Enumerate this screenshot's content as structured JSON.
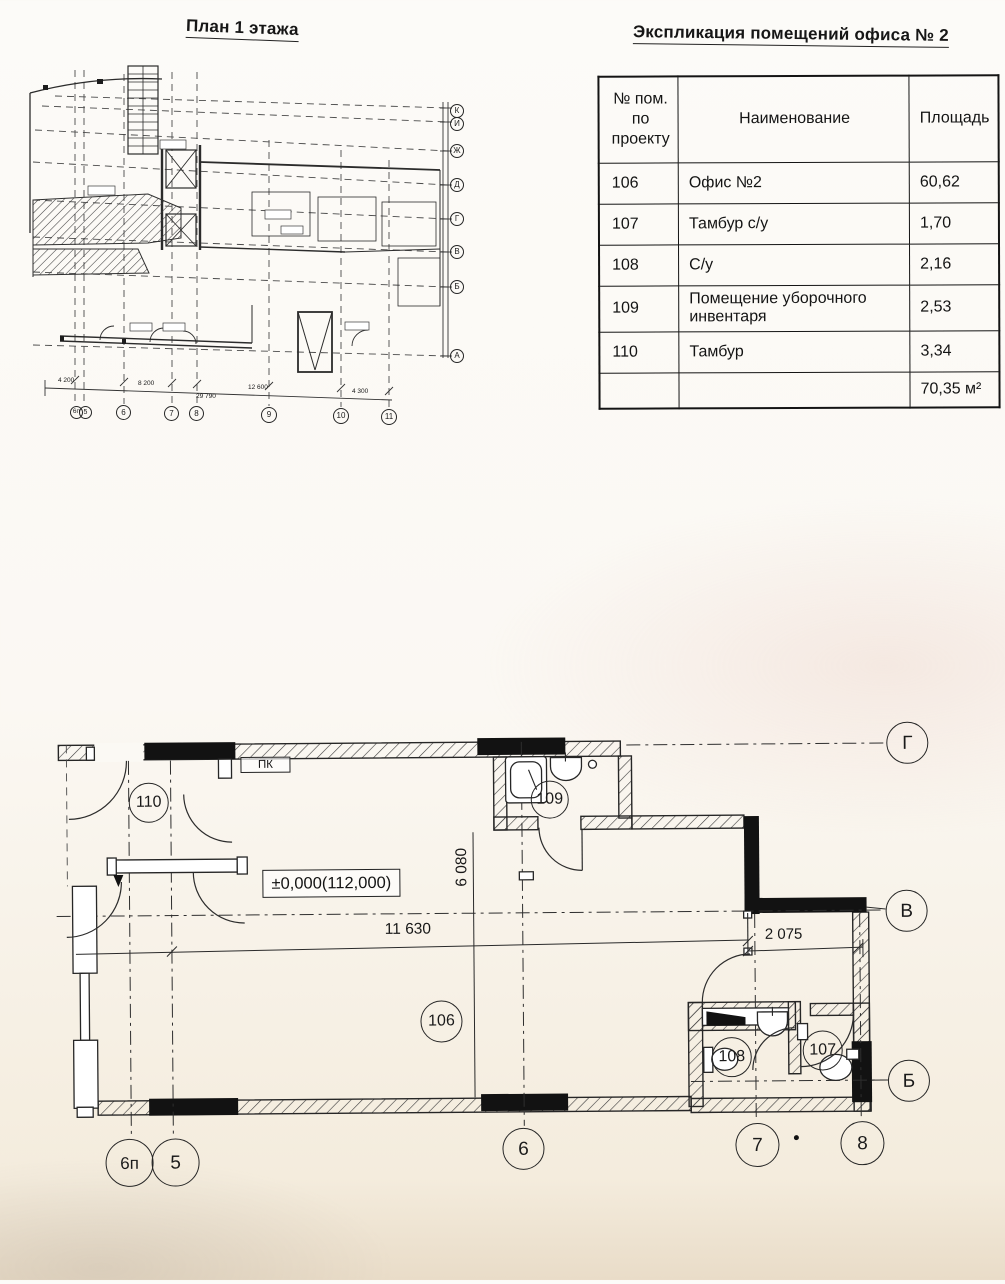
{
  "titles": {
    "plan": "План 1 этажа",
    "table": "Экспликация помещений офиса № 2"
  },
  "table": {
    "columns": {
      "num": "№ пом.\nпо\nпроекту",
      "name": "Наименование",
      "area": "Площадь"
    },
    "rows": [
      {
        "num": "106",
        "name": "Офис №2",
        "area": "60,62"
      },
      {
        "num": "107",
        "name": "Тамбур с/у",
        "area": "1,70"
      },
      {
        "num": "108",
        "name": "С/у",
        "area": "2,16"
      },
      {
        "num": "109",
        "name": "Помещение уборочного инвентаря",
        "area": "2,53"
      },
      {
        "num": "110",
        "name": "Тамбур",
        "area": "3,34"
      }
    ],
    "total_area": "70,35 м²"
  },
  "small_plan": {
    "right_axes": [
      "К",
      "И",
      "Ж",
      "Д",
      "Г",
      "В",
      "Б",
      "А"
    ],
    "bottom_axes": [
      "6п",
      "5",
      "6",
      "7",
      "8",
      "9",
      "10",
      "11"
    ],
    "dims": [
      "4 200",
      "8 200",
      "12 600",
      "4 300"
    ],
    "dim_total": "29 790"
  },
  "big_plan": {
    "rooms": {
      "r110": "110",
      "r109": "109",
      "r106": "106",
      "r108": "108",
      "r107": "107"
    },
    "axes": {
      "g": "Г",
      "v": "В",
      "b": "Б",
      "a6p": "6п",
      "a5": "5",
      "a6": "6",
      "a7": "7",
      "a8": "8"
    },
    "dims": {
      "height": "6 080",
      "width": "11 630",
      "right": "2 075"
    },
    "level": "±0,000(112,000)",
    "pk": "ПК"
  }
}
